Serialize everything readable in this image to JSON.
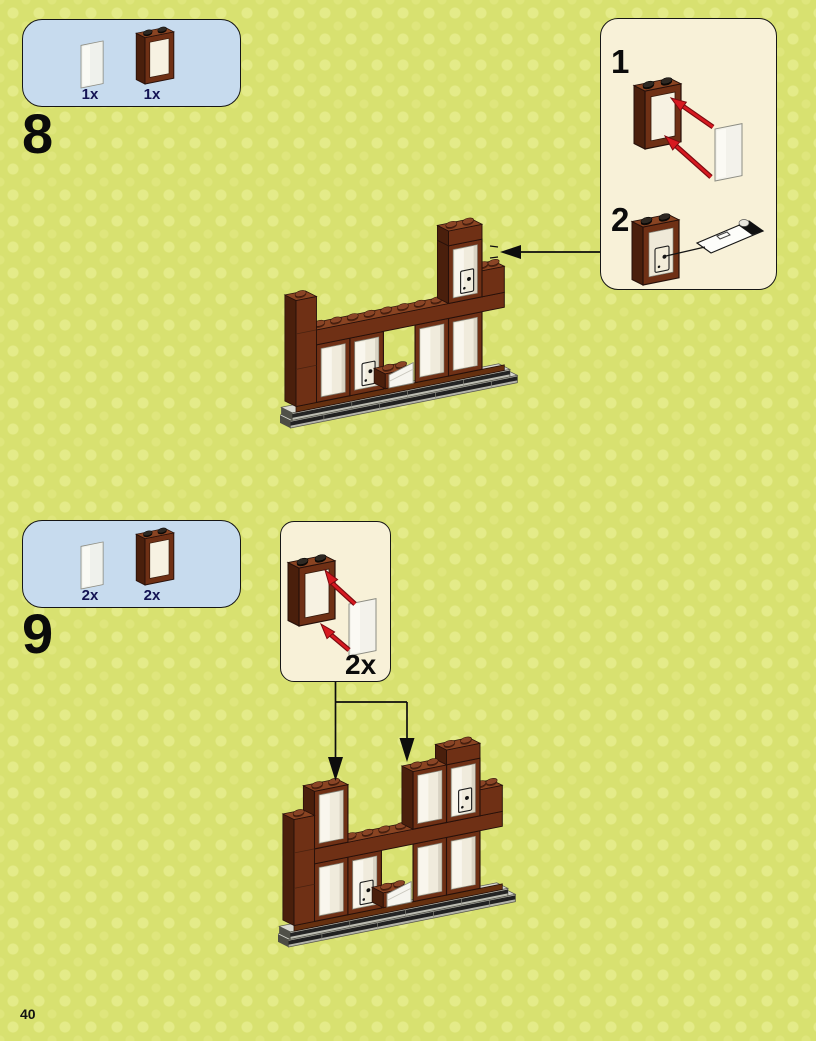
{
  "page": {
    "number": "40"
  },
  "steps": [
    {
      "number": "8",
      "parts": [
        {
          "qty": "1x",
          "name": "window-pane"
        },
        {
          "qty": "1x",
          "name": "window-frame"
        }
      ],
      "inset": {
        "substeps": [
          {
            "label": "1"
          },
          {
            "label": "2"
          }
        ]
      }
    },
    {
      "number": "9",
      "parts": [
        {
          "qty": "2x",
          "name": "window-pane"
        },
        {
          "qty": "2x",
          "name": "window-frame"
        }
      ],
      "inset": {
        "count_label": "2x"
      }
    }
  ],
  "colors": {
    "background": "#d8e170",
    "parts_box": "#c7dbee",
    "inset_box": "#f8f1d8",
    "brick_brown_front": "#6f3015",
    "brick_brown_side": "#4a1f0c",
    "brick_brown_top": "#8a4422",
    "arrow_red": "#d71920",
    "qty_label": "#131353"
  }
}
